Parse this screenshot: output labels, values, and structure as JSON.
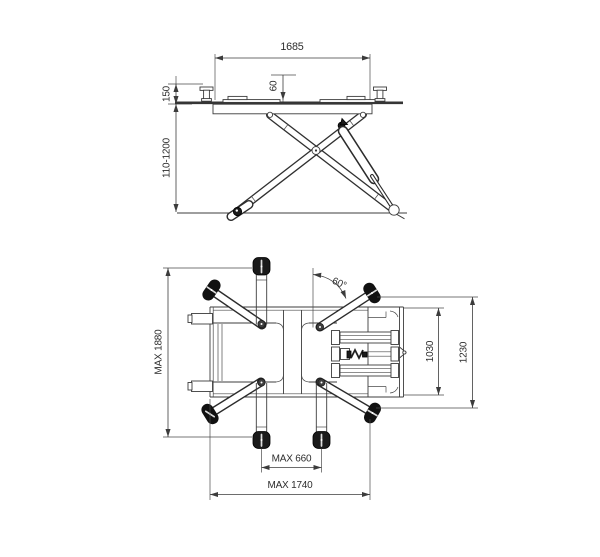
{
  "colors": {
    "background": "#ffffff",
    "line": "#3c3c3c",
    "dark_fill": "#1a1a1a"
  },
  "side_view": {
    "dims": {
      "platform_length": "1685",
      "pad_height": "60",
      "min_height": "150",
      "lift_range": "110-1200"
    }
  },
  "plan_view": {
    "dims": {
      "overall_length": "MAX 1880",
      "arm_angle": "60°",
      "width_inner": "1030",
      "width_outer": "1230",
      "wheel_span_inner": "MAX 660",
      "wheel_span_outer": "MAX 1740"
    }
  }
}
